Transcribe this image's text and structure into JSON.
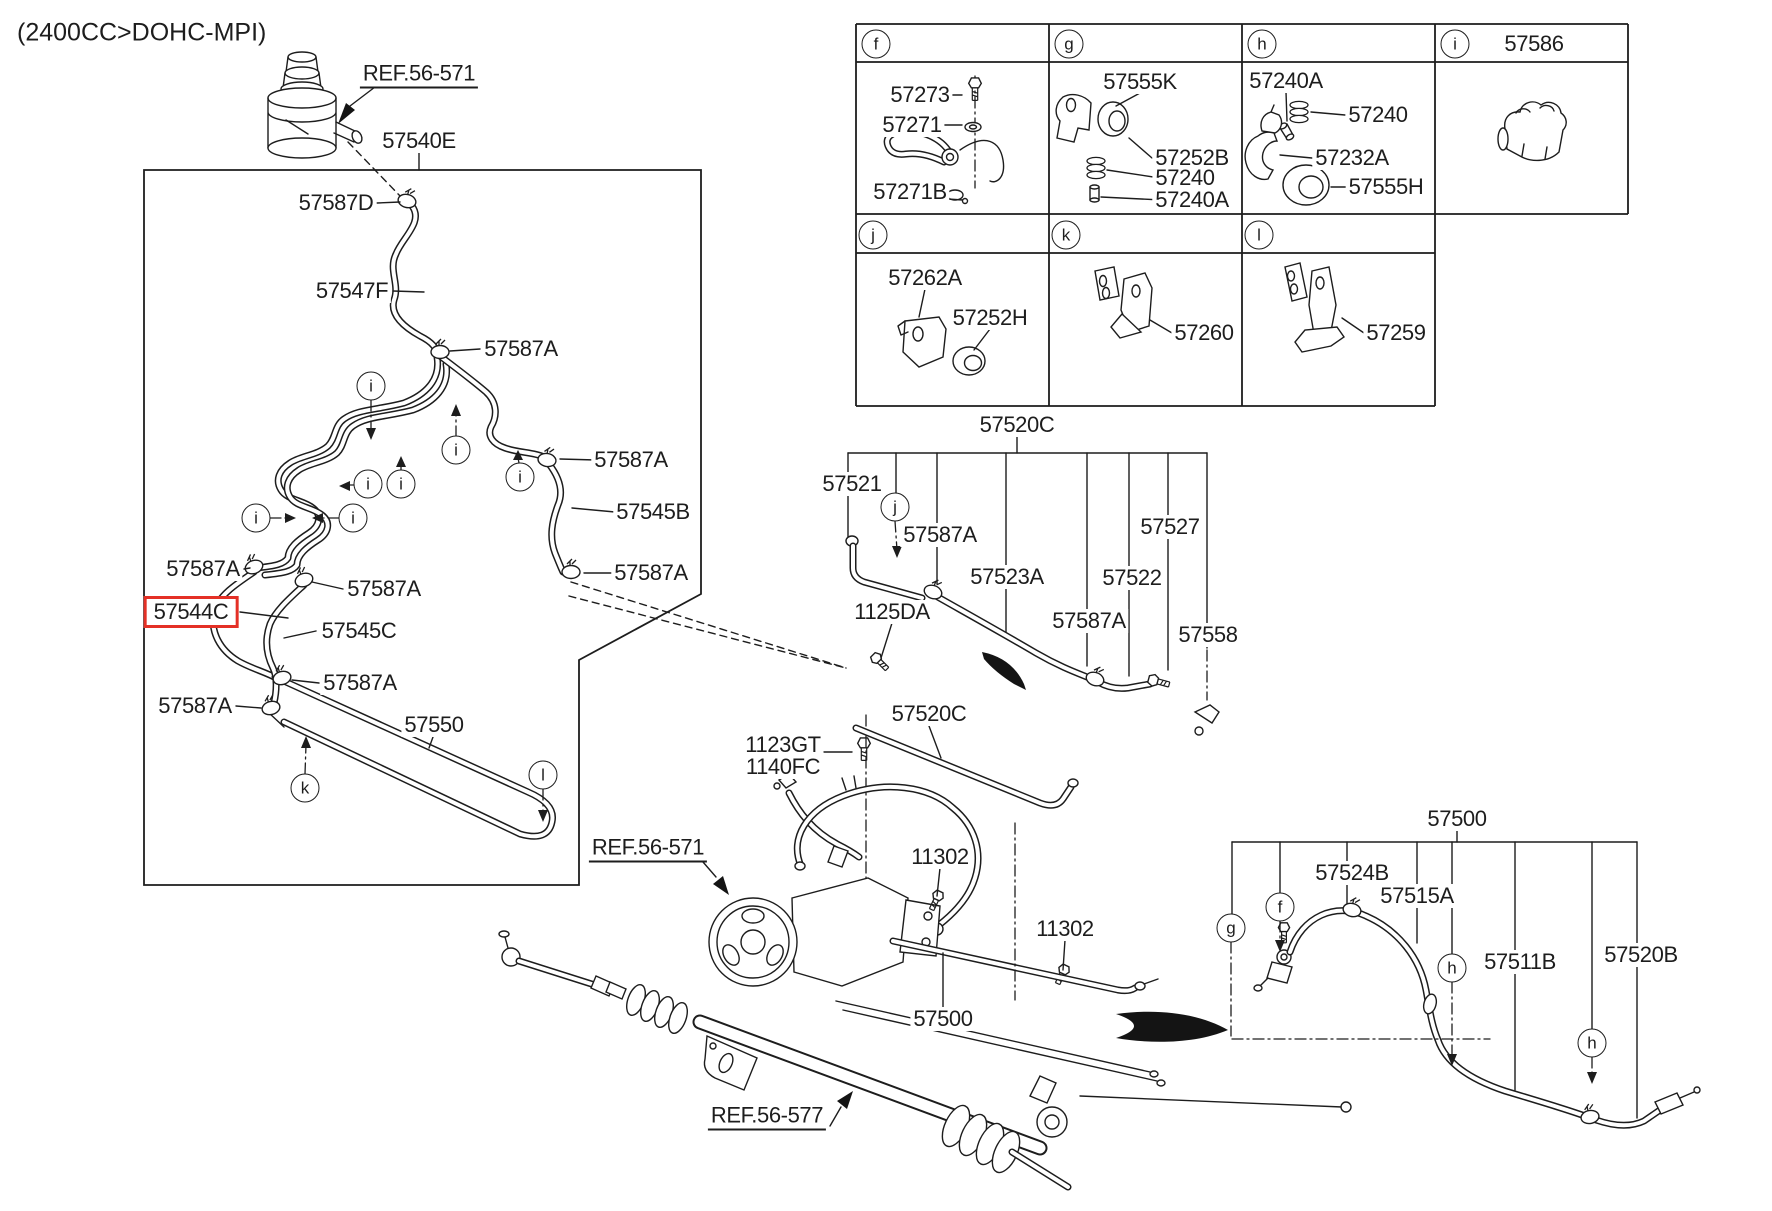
{
  "title": "(2400CC>DOHC-MPI)",
  "colors": {
    "ink": "#1d1d1d",
    "highlight": "#e43026",
    "background": "#ffffff"
  },
  "highlighted_part": "57544C",
  "labels": [
    {
      "text": "(2400CC>DOHC-MPI)"
    },
    {
      "text": "REF.56-571"
    },
    {
      "text": "57540E"
    },
    {
      "text": "57587D"
    },
    {
      "text": "57547F"
    },
    {
      "text": "57587A"
    },
    {
      "text": "57587A"
    },
    {
      "text": "57545B"
    },
    {
      "text": "57587A"
    },
    {
      "text": "57587A"
    },
    {
      "text": "57587A"
    },
    {
      "text": "57544C",
      "highlighted": true
    },
    {
      "text": "57545C"
    },
    {
      "text": "57587A"
    },
    {
      "text": "57587A"
    },
    {
      "text": "57550"
    },
    {
      "text": "REF.56-571"
    },
    {
      "text": "1123GT"
    },
    {
      "text": "1140FC"
    },
    {
      "text": "11302"
    },
    {
      "text": "11302"
    },
    {
      "text": "57500"
    },
    {
      "text": "REF.56-577"
    },
    {
      "text": "57520C"
    },
    {
      "text": "57521"
    },
    {
      "text": "57587A"
    },
    {
      "text": "57523A"
    },
    {
      "text": "1125DA"
    },
    {
      "text": "57587A"
    },
    {
      "text": "57522"
    },
    {
      "text": "57527"
    },
    {
      "text": "57558"
    },
    {
      "text": "57520C"
    },
    {
      "text": "57500"
    },
    {
      "text": "57524B"
    },
    {
      "text": "57515A"
    },
    {
      "text": "57511B"
    },
    {
      "text": "57520B"
    },
    {
      "text": "57273"
    },
    {
      "text": "57271"
    },
    {
      "text": "57271B"
    },
    {
      "text": "57555K"
    },
    {
      "text": "57252B"
    },
    {
      "text": "57240"
    },
    {
      "text": "57240A"
    },
    {
      "text": "57240A"
    },
    {
      "text": "57240"
    },
    {
      "text": "57232A"
    },
    {
      "text": "57555H"
    },
    {
      "text": "57586"
    },
    {
      "text": "57262A"
    },
    {
      "text": "57252H"
    },
    {
      "text": "57260"
    },
    {
      "text": "57259"
    }
  ],
  "callouts": [
    {
      "letter": "f"
    },
    {
      "letter": "g"
    },
    {
      "letter": "h"
    },
    {
      "letter": "i"
    },
    {
      "letter": "j"
    },
    {
      "letter": "k"
    },
    {
      "letter": "l"
    },
    {
      "letter": "i"
    },
    {
      "letter": "i"
    },
    {
      "letter": "i"
    },
    {
      "letter": "i"
    },
    {
      "letter": "i"
    },
    {
      "letter": "i"
    },
    {
      "letter": "i"
    },
    {
      "letter": "k"
    },
    {
      "letter": "l"
    },
    {
      "letter": "j"
    },
    {
      "letter": "g"
    },
    {
      "letter": "f"
    },
    {
      "letter": "h"
    },
    {
      "letter": "h"
    }
  ]
}
